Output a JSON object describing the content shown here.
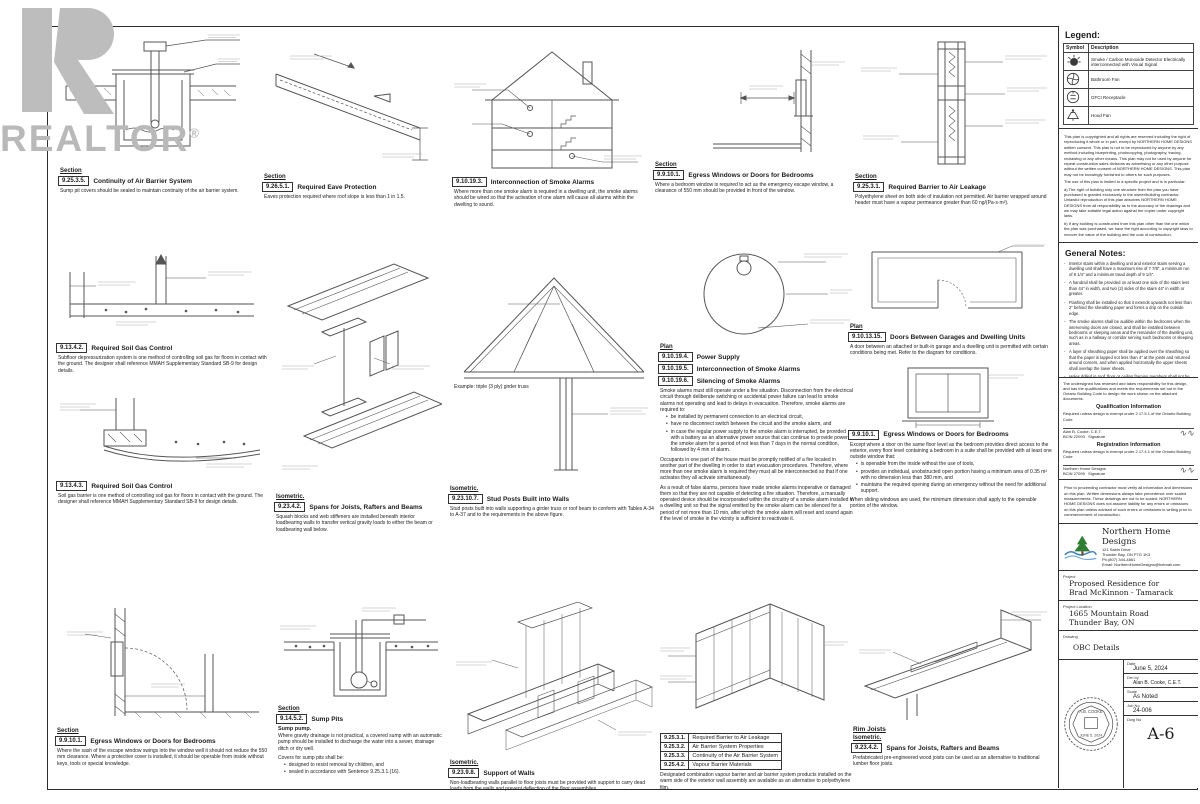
{
  "watermark": {
    "text": "REALTOR",
    "registered": "®"
  },
  "legend": {
    "title": "Legend:",
    "col_symbol": "Symbol",
    "col_desc": "Description",
    "rows": [
      {
        "desc": "Smoke / Carbon Monoxide Detector Electrically interconnected with Visual Signal"
      },
      {
        "desc": "Bathroom Fan"
      },
      {
        "desc": "GFCI Receptacle"
      },
      {
        "desc": "Hood Fan"
      }
    ]
  },
  "copyright": {
    "p1": "This plan is copyrighted and all rights are reserved including the right of reproducing it whole or in part, except by NORTHERN HOME DESIGNS written consent. This plan is not to be reproduced by anyone by any method including blueprinting, photocopying, photography, tracing, redrawing or any other means. This plan may not be used by anyone for repeat construction sales divisions as advertising or any other purpose without the written consent of NORTHERN HOME DESIGNS. This plan may not be knowingly furnished to others for such purposes.",
    "p2": "The use of this plan is limited to a specific project and is in particular:",
    "p3": "a) The right of building only one structure from the plan you have purchased is granted exclusively to the owner/building contractor. Unlawful reproduction of this plan absolves NORTHERN HOME DESIGNS from all responsibility as to the accuracy of the drawings and we may take suitable legal action against the copier under copyright laws.",
    "p4": "b) If any building is constructed from this plan other than the one which the plan was purchased, we have the right according to copyright laws to recover the value of the building and the cost of construction."
  },
  "notes": {
    "title": "General Notes:",
    "items": [
      "Interior stairs within a dwelling unit and exterior stairs serving a dwelling unit shall have a maximum rise of 7 7/8″, a minimum run of 8 1/4″ and a minimum tread depth of 9 1/4″.",
      "A handrail shall be provided on at least one side of the stairs less than 44″ in width, and two (2) sides of the stairs 44″ in width or greater.",
      "Flashing shall be installed so that it extends upwards not less than 2″ behind the sheathing paper and forms a drip on the outside edge.",
      "The smoke alarms shall be audible within the bedrooms when the intervening doors are closed, and shall be installed between bedrooms or sleeping areas and the remainder of the dwelling unit, such as in a hallway or corridor serving such bedrooms or sleeping areas.",
      "A layer of sheathing paper shall be applied over the sheathing so that the paper is lapped not less than 4″ at the joints and returned around corners, and when applied horizontally the upper sheets shall overlap the lower sheets.",
      "Holes drilled in roof, floor or ceiling framing members shall not be larger than 1/4 the depth of the member and shall be located not less than 2″ from the edges, unless the depth of the member is increased by the size of the hole.",
      "Where beams are built up of individual members, the members shall be fastened together in accordance with OBC 9.23.8.3.",
      "Holes in the top plate of a loadbearing wall shall be reinforced where more than one-third of the plate width is cut away.",
      "Joists shall be restrained from twisting at each end by toe-nailing, end-nailing, strapping or blocking.",
      "Provide Carbon Monoxide Detectors in Bedroom Areas.",
      "Non-loadbearing partitions parallel to the floor joists shall be supported on joists or on blocking between the joists.",
      "Trusses shall be of engineered design and shop drawings shall be submitted for approval prior to installation.",
      "Eave protection shall extend from the edge of the roof not less than 36″ up the roof slope to a line not less than 12″ inside the inner face of the exterior wall.",
      "Every vapour barrier joint shall be lapped not less than 4″ over supporting members and sealed all around."
    ]
  },
  "attest": {
    "statement": "The undersigned has reviewed and takes responsibility for this design, and has the qualifications and meets the requirements set out in the Ontario Building Code to design the work shown on the attached documents.",
    "qual_heading": "Qualification Information",
    "qual_req": "Required unless design is exempt under 2.17.5.1 of the Ontario Building Code",
    "qual_name": "Alan B. Cooke, C.E.T.",
    "qual_bcin": "BCIN 22093",
    "reg_heading": "Registration Information",
    "reg_req": "Required unless design is exempt under 2.17.4.1 of the Ontario Building Code",
    "reg_name": "Northern Home Designs",
    "reg_bcin": "BCIN 27099",
    "signature_label": "Signature"
  },
  "disclaimer": "Prior to proceeding contractor must verify all information and dimensions on this plan. Written dimensions always take precedence over scaled measurements. These drawings are not to be scaled. NORTHERN HOME DESIGNS does not assume liability for any errors or omissions on this plan unless advised of such errors or omissions in writing prior to commencement of construction.",
  "firm": {
    "name": "Northern Home Designs",
    "addr1": "121 Sabin Drive",
    "addr2": "Thunder Bay, ON  P7G 1K3",
    "phone": "Ph.(807) 344-4861",
    "email": "Email: NorthernHomeDesigns@hotmail.com"
  },
  "tb": {
    "project_label": "Project",
    "project_line1": "Proposed Residence for",
    "project_line2": "Brad McKinnon - Tamarack",
    "location_label": "Project Location",
    "location_line1": "1665 Mountain Road",
    "location_line2": "Thunder Bay, ON",
    "drawing_label": "Drawing",
    "drawing_value": "OBC Details",
    "date_label": "Date",
    "date_value": "June 5, 2024",
    "drn_label": "Drn by",
    "drn_value": "Alan B. Cooke, C.E.T.",
    "scale_label": "Scale",
    "scale_value": "As Noted",
    "job_label": "Job No",
    "job_value": "24-006",
    "dwg_label": "Dwg No",
    "dwg_value": "A-6"
  },
  "stamp": {
    "name": "A.B. COOKE",
    "date": "JUNE 5, 2024"
  },
  "details": {
    "d1": {
      "view": "Section",
      "code": "9.25.3.5.",
      "title": "Continuity of Air Barrier System",
      "caption": "Sump pit covers should be sealed to maintain continuity of the air barrier system."
    },
    "d2": {
      "view": "Section",
      "code": "9.26.5.1.",
      "title": "Required Eave Protection",
      "caption": "Eaves protection required where roof slope is less than 1 in 1.5."
    },
    "d3": {
      "view": "Section",
      "code": "9.10.19.3.",
      "title": "Interconnection of Smoke Alarms",
      "caption": "Where more than one smoke alarm is required in a dwelling unit, the smoke alarms should be wired so that the activation of one alarm will cause all alarms within the dwelling to sound."
    },
    "d4": {
      "view": "Section",
      "code": "9.9.10.1.",
      "title": "Egress Windows or Doors for Bedrooms",
      "caption": "Where a bedroom window is required to act as the emergency escape window, a clearance of 550 mm should be provided in front of the window."
    },
    "d5": {
      "view": "Section",
      "code": "9.25.3.1.",
      "title": "Required Barrier to Air Leakage",
      "caption": "Polyethylene sheet on both side of insulation not permitted. Air barrier wrapped around header must have a vapour permeance greater than 60 ng/(Pa·s·m²)."
    },
    "d6": {
      "code": "9.13.4.2.",
      "title": "Required Soil Gas Control",
      "caption": "Subfloor depressurization system is one method of controlling soil gas for floors in contact with the ground. The designer shall reference MMAH Supplementary Standard SB-9 for design details."
    },
    "d7": {
      "code": "9.13.4.3.",
      "title": "Required Soil Gas Control",
      "caption": "Soil gas barrier is one method of controlling soil gas for floors in contact with the ground. The designer shall reference MMAH Supplementary Standard SB-9 for design details."
    },
    "d8": {
      "view": "Isometric.",
      "code": "9.23.4.2.",
      "title": "Spans for Joists, Rafters and Beams",
      "caption": "Squash blocks and web stiffeners are installed beneath interior loadbearing walls to transfer vertical gravity loads to either the beam or loadbearing wall below."
    },
    "d9": {
      "view": "Isometric.",
      "code": "9.23.10.7.",
      "title": "Stud Posts Built into Walls",
      "note": "Example: triple (3 ply) girder truss",
      "caption": "Stud posts built into walls supporting a girder truss or roof beam to conform with Tables A-34 to A-37 and to the requirements in the above figure."
    },
    "d10": {
      "view": "Plan",
      "rows": [
        {
          "code": "9.10.19.4.",
          "title": "Power Supply"
        },
        {
          "code": "9.10.19.5.",
          "title": "Interconnection of Smoke Alarms"
        },
        {
          "code": "9.10.19.6.",
          "title": "Silencing of Smoke Alarms"
        }
      ],
      "intro": "Smoke alarms must still operate under a fire situation. Disconnection from the electrical circuit through deliberate switching or accidental power failure can lead to smoke alarms not operating and lead to delays in evacuation. Therefore, smoke alarms are required to:",
      "bullets": [
        "be installed by permanent connection to an electrical circuit,",
        "have no disconnect switch between the circuit and the smoke alarm, and",
        "in case the regular power supply to the smoke alarm is interrupted, be provided with a battery as an alternative power source that can continue to provide power to the smoke alarm for a period of not less than 7 days in the normal condition, followed by 4 min of alarm."
      ],
      "p2": "Occupants in one part of the house must be promptly notified of a fire located in another part of the dwelling in order to start evacuation procedures. Therefore, where more than one smoke alarm is required they must all be interconnected so that if one activates they all activate simultaneously.",
      "p3": "As a result of false alarms, persons have made smoke alarms inoperative or damaged them so that they are not capable of detecting a fire situation. Therefore, a manually operated device should be incorporated within the circuitry of a smoke alarm installed in a dwelling unit so that the signal emitted by the smoke alarm can be silenced for a period of not more than 10 min, after which the smoke alarm will reset and sound again if the level of smoke in the vicinity is sufficient to reactivate it."
    },
    "d11": {
      "view": "Plan",
      "code": "9.10.13.15.",
      "title": "Doors Between Garages and Dwelling Units",
      "caption": "A door between an attached or built-in garage and a dwelling unit is permitted with certain conditions being met. Refer to the diagram for conditions."
    },
    "d11b": {
      "code": "9.9.10.1.",
      "title": "Egress Windows or Doors for Bedrooms",
      "intro": "Except where a door on the same floor level as the bedroom provides direct access to the exterior, every floor level containing a bedroom in a suite shall be provided with at least one outside window that:",
      "bullets": [
        "is openable from the inside without the use of tools,",
        "provides an individual, unobstructed open portion having a minimum area of 0.35 m² with no dimension less than 380 mm, and",
        "maintains the required opening during an emergency without the need for additional support."
      ],
      "note": "When sliding windows are used, the minimum dimension shall apply to the openable portion of the window."
    },
    "d12": {
      "view": "Section",
      "code": "9.9.10.1.",
      "title": "Egress Windows or Doors for Bedrooms",
      "caption": "Where the sash of the escape window swings into the window well it should not reduce the 550 mm clearance. Where a protective cover is installed, it should be operable from inside without keys, tools or special knowledge."
    },
    "d13": {
      "view": "Section",
      "code": "9.14.5.2.",
      "title": "Sump Pits",
      "sub": "Sump pump.",
      "caption": "Where gravity drainage is not practical, a covered sump with an automatic pump should be installed to discharge the water into a sewer, drainage ditch or dry well.",
      "covers": "Covers for sump pits shall be:",
      "bullets": [
        "designed to resist removal by children, and",
        "sealed in accordance with Sentence 9.25.3.1.(16)."
      ]
    },
    "d14": {
      "view": "Isometric.",
      "code": "9.23.9.8.",
      "title": "Support of Walls",
      "caption": "Non-loadbearing walls parallel to floor joists must be provided with support to carry dead loads from the walls and prevent deflection of the floor assemblies."
    },
    "d15": {
      "rows": [
        {
          "code": "9.25.3.1.",
          "title": "Required Barrier to Air Leakage"
        },
        {
          "code": "9.25.3.2.",
          "title": "Air Barrier System Properties"
        },
        {
          "code": "9.25.3.3.",
          "title": "Continuity of the Air Barrier System"
        },
        {
          "code": "9.25.4.2.",
          "title": "Vapour Barrier Materials"
        }
      ],
      "caption": "Designated combination vapour barrier and air barrier system products installed on the warm side of the exterior wall assembly are available as an alternative to polyethylene film."
    },
    "d16": {
      "heading": "Rim Joists",
      "view": "Isometric.",
      "code": "9.23.4.2.",
      "title": "Spans for Joists, Rafters and Beams",
      "caption": "Prefabricated pre-engineered wood joists can be used as an alternative to traditional lumber floor joists."
    }
  }
}
